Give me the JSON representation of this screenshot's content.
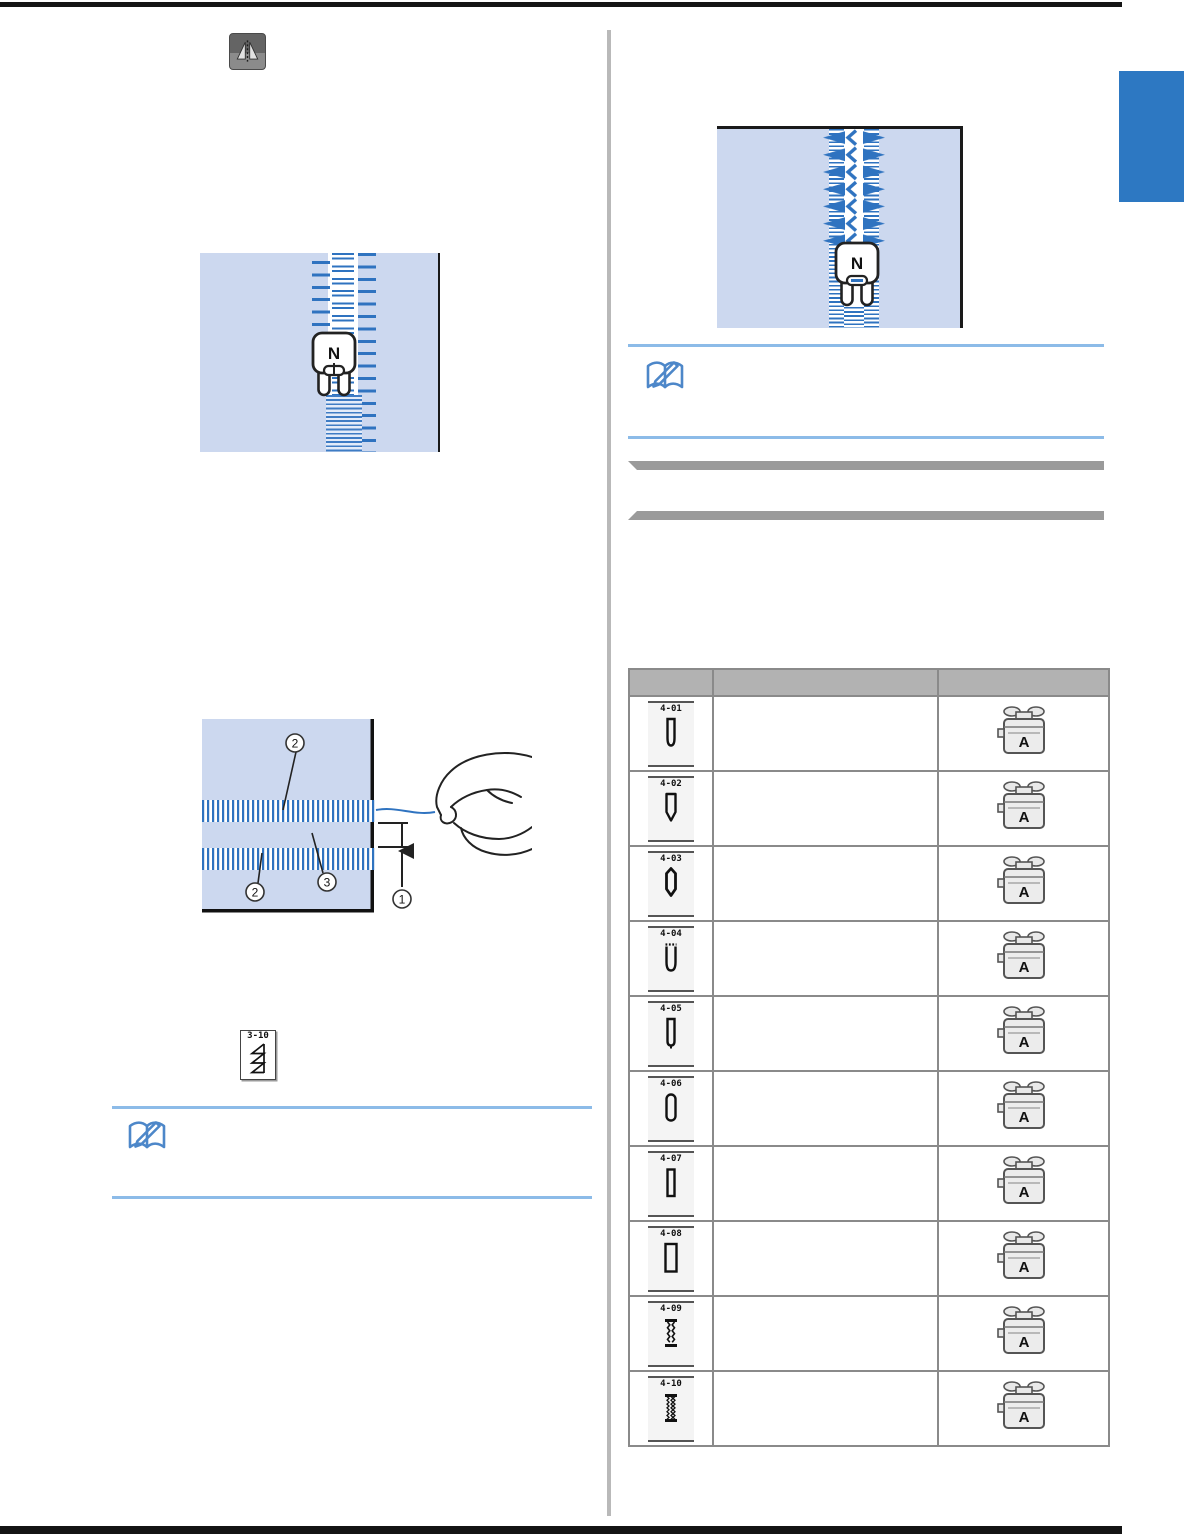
{
  "page": {
    "kind": "sewing-machine-manual-page"
  },
  "colors": {
    "fabric_blue": "#ccd8ef",
    "stitch_blue": "#2f73c0",
    "note_line_blue": "#8cbbe8",
    "note_icon_blue": "#4d87c9",
    "chapter_tab_blue": "#2d78c2",
    "section_bar_gray": "#9a9a9a",
    "table_header_gray": "#b2b2b2"
  },
  "left_column": {
    "mirror_button_icon": "mirror-image",
    "zipper_figure": {
      "presser_foot_label": "N"
    },
    "hem_figure": {
      "callouts": {
        "distance": "1",
        "stitch_top": "2",
        "stitch_bottom": "2",
        "gap": "3"
      }
    },
    "stitch_chip": {
      "label": "3-10"
    },
    "note_icon": "note-book-pencil"
  },
  "right_column": {
    "zipper_figure": {
      "presser_foot_label": "N"
    },
    "note_icon": "note-book-pencil",
    "table": {
      "rows": [
        {
          "stitch_label": "4-01",
          "foot_label": "A"
        },
        {
          "stitch_label": "4-02",
          "foot_label": "A"
        },
        {
          "stitch_label": "4-03",
          "foot_label": "A"
        },
        {
          "stitch_label": "4-04",
          "foot_label": "A"
        },
        {
          "stitch_label": "4-05",
          "foot_label": "A"
        },
        {
          "stitch_label": "4-06",
          "foot_label": "A"
        },
        {
          "stitch_label": "4-07",
          "foot_label": "A"
        },
        {
          "stitch_label": "4-08",
          "foot_label": "A"
        },
        {
          "stitch_label": "4-09",
          "foot_label": "A"
        },
        {
          "stitch_label": "4-10",
          "foot_label": "A"
        }
      ]
    }
  }
}
